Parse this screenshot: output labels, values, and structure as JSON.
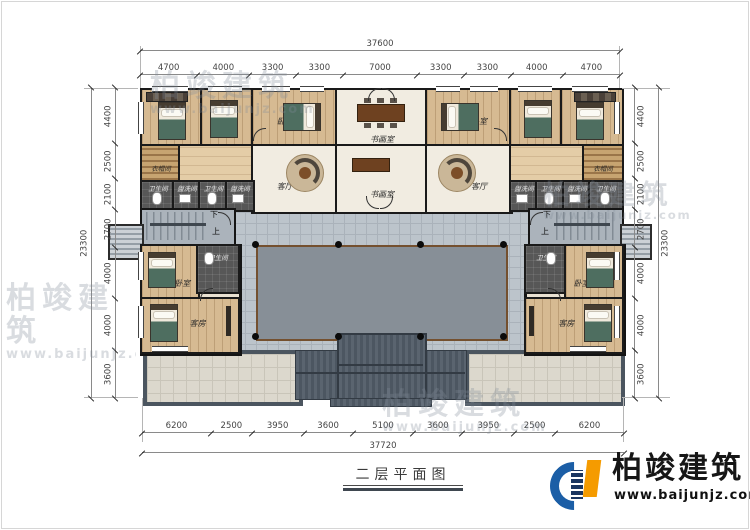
{
  "title": {
    "text": "二层平面图"
  },
  "logo": {
    "name": "柏竣建筑",
    "url": "www.baijunjz.com"
  },
  "watermark": {
    "name": "柏竣建筑",
    "url": "www.baijunjz.com"
  },
  "dims": {
    "top_total": [
      "37600"
    ],
    "top": [
      "4700",
      "4000",
      "3300",
      "3300",
      "7000",
      "3300",
      "3300",
      "4000",
      "4700"
    ],
    "bottom": [
      "6200",
      "2500",
      "3950",
      "3600",
      "5100",
      "3600",
      "3950",
      "2500",
      "6200"
    ],
    "bottom_total": [
      "37720"
    ],
    "side": [
      "4400",
      "2500",
      "2100",
      "2700",
      "4000",
      "4000",
      "3600"
    ],
    "side_total": [
      "23300"
    ]
  },
  "rooms": {
    "bedroom": "卧室",
    "art_study": "书画室",
    "living": "客厅",
    "guest": "客房",
    "cloakroom": "衣帽间",
    "bathroom": "卫生间",
    "washroom": "盥洗间",
    "stairs_down": "下",
    "stairs_up": "上"
  }
}
